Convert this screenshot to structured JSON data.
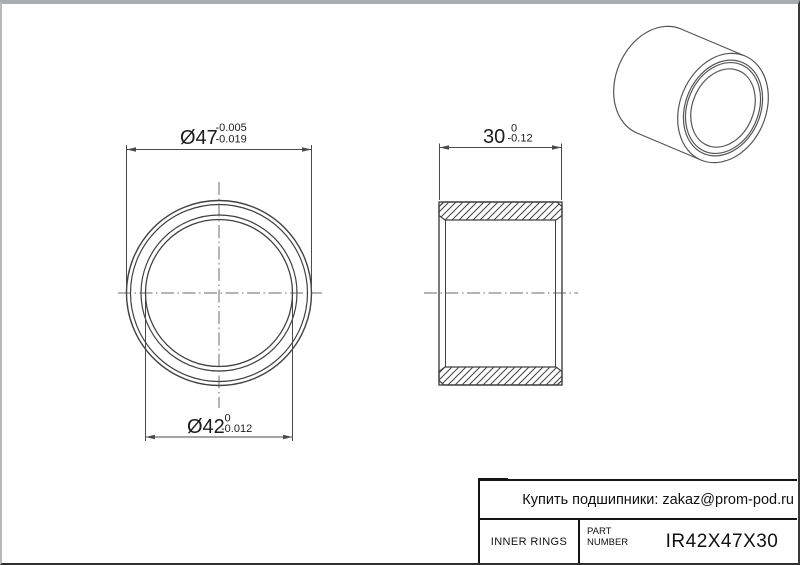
{
  "drawing": {
    "dim_outer": {
      "value": "Ø47",
      "tol_upper": "-0.005",
      "tol_lower": "-0.019"
    },
    "dim_bore": {
      "value": "Ø42",
      "tol_upper": "0",
      "tol_lower": "-0.012"
    },
    "dim_width": {
      "value": "30",
      "tol_upper": "0",
      "tol_lower": "-0.12"
    }
  },
  "title_block": {
    "contact": "Купить подшипники: zakaz@prom-pod.ru",
    "category": "INNER RINGS",
    "part_label_1": "PART",
    "part_label_2": "NUMBER",
    "part_number": "IR42X47X30"
  },
  "colors": {
    "geometry_line": "#414141",
    "iso_line": "#565656",
    "center_line": "#6b6b6b",
    "dimension_line": "#4a4a4a",
    "text": "#1c1c1c",
    "frame_dark": "#141414",
    "frame_gray": "#a9adb0"
  }
}
